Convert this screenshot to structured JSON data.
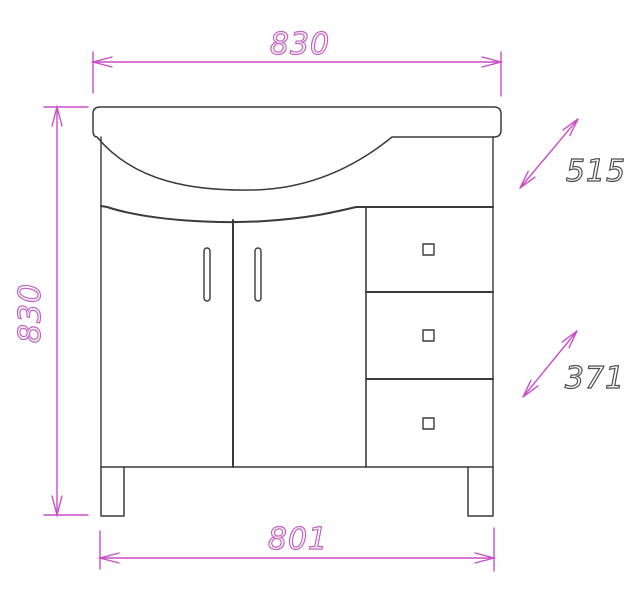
{
  "diagram": {
    "subject": "Dimensioned front elevation of a bathroom vanity cabinet with curved sink top, two doors and three drawers",
    "colors": {
      "background": "#ffffff",
      "cabinet_outline": "#3a3a3a",
      "dimension_lines": "#c84fc8",
      "dimension_text_primary": "#c361c3",
      "dimension_text_secondary": "#4e4e4e"
    },
    "dimensions": {
      "top_width": "830",
      "left_height": "830",
      "diagonal_upper": "515",
      "diagonal_lower": "371",
      "bottom_width": "801"
    }
  }
}
